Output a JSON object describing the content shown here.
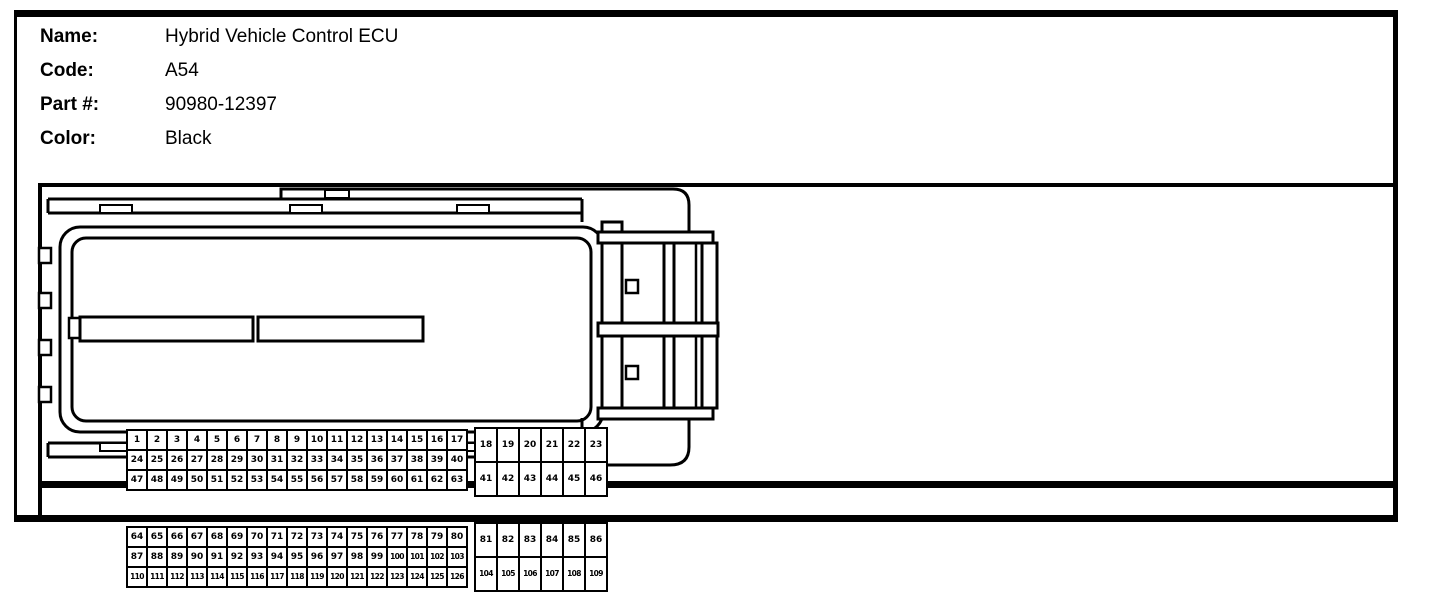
{
  "header": {
    "fields": [
      {
        "label": "Name:",
        "value": "Hybrid Vehicle Control ECU"
      },
      {
        "label": "Code:",
        "value": "A54"
      },
      {
        "label": "Part #:",
        "value": "90980-12397"
      },
      {
        "label": "Color:",
        "value": "Black"
      }
    ]
  },
  "connector": {
    "description": "126-pin ECU connector front view with side latch view",
    "colors": {
      "line": "#000000",
      "background": "#ffffff"
    },
    "blocks": {
      "top_left": {
        "rows": [
          [
            1,
            2,
            3,
            4,
            5,
            6,
            7,
            8,
            9,
            10,
            11,
            12,
            13,
            14,
            15,
            16,
            17
          ],
          [
            24,
            25,
            26,
            27,
            28,
            29,
            30,
            31,
            32,
            33,
            34,
            35,
            36,
            37,
            38,
            39,
            40
          ],
          [
            47,
            48,
            49,
            50,
            51,
            52,
            53,
            54,
            55,
            56,
            57,
            58,
            59,
            60,
            61,
            62,
            63
          ]
        ]
      },
      "top_right": {
        "rows": [
          [
            18,
            19,
            20,
            21,
            22,
            23
          ],
          [
            41,
            42,
            43,
            44,
            45,
            46
          ]
        ]
      },
      "bottom_left": {
        "rows": [
          [
            64,
            65,
            66,
            67,
            68,
            69,
            70,
            71,
            72,
            73,
            74,
            75,
            76,
            77,
            78,
            79,
            80
          ],
          [
            87,
            88,
            89,
            90,
            91,
            92,
            93,
            94,
            95,
            96,
            97,
            98,
            99,
            100,
            101,
            102,
            103
          ],
          [
            110,
            111,
            112,
            113,
            114,
            115,
            116,
            117,
            118,
            119,
            120,
            121,
            122,
            123,
            124,
            125,
            126
          ]
        ]
      },
      "bottom_right": {
        "rows": [
          [
            81,
            82,
            83,
            84,
            85,
            86
          ],
          [
            104,
            105,
            106,
            107,
            108,
            109
          ]
        ]
      }
    }
  }
}
